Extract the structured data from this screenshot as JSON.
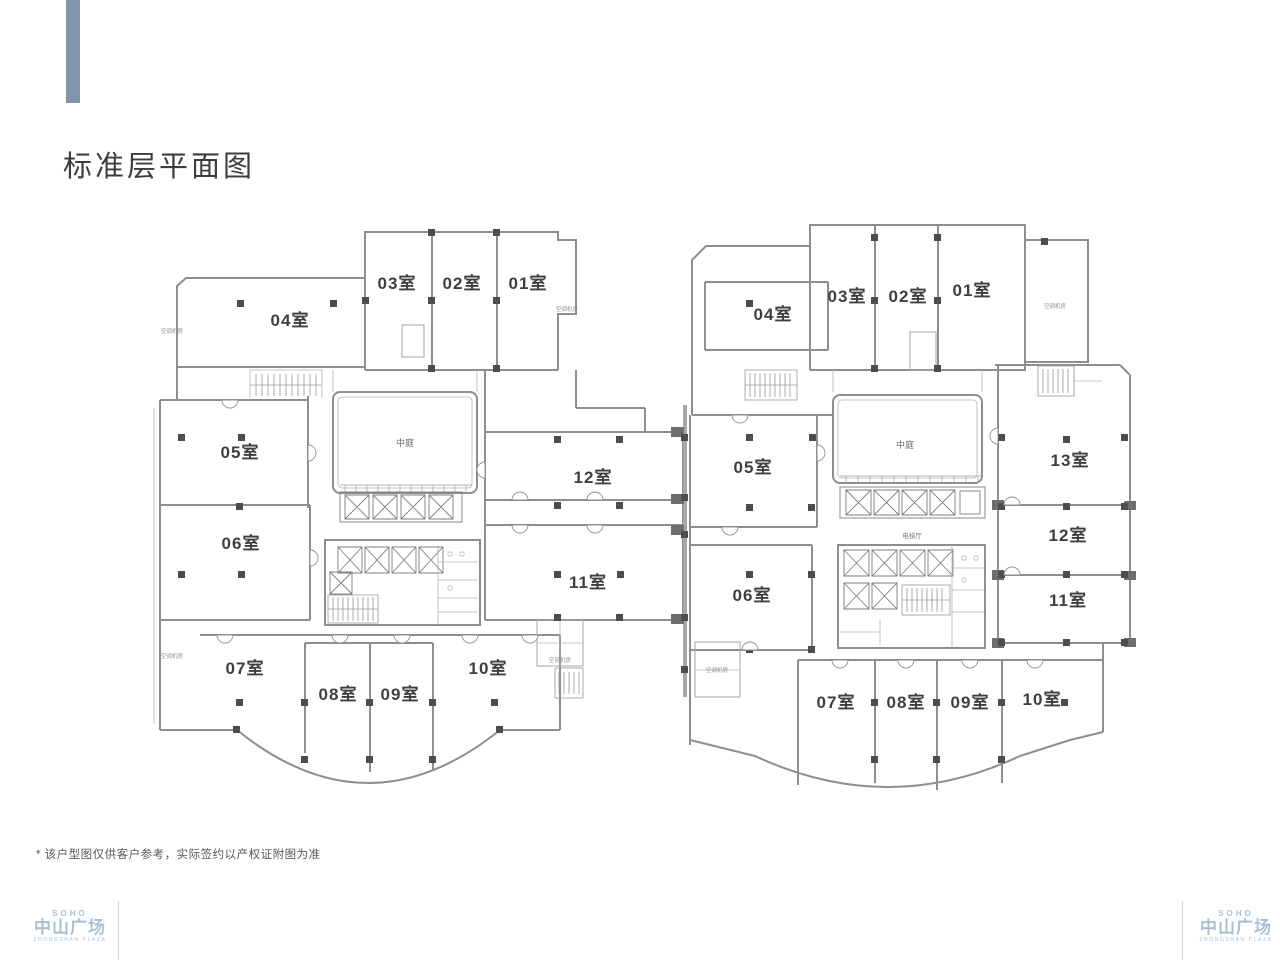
{
  "page": {
    "title": "标准层平面图",
    "footnote": "* 该户型图仅供客户参考，实际签约以产权证附图为准"
  },
  "logo": {
    "brand": "SOHO",
    "name": "中山广场",
    "subtitle": "ZHONGSHAN PLAZA"
  },
  "plans": {
    "atrium_label": "中庭",
    "elevator_hall_label": "电梯厅",
    "service_label": "空调机房",
    "left": {
      "rooms": [
        {
          "label": "01室"
        },
        {
          "label": "02室"
        },
        {
          "label": "03室"
        },
        {
          "label": "04室"
        },
        {
          "label": "05室"
        },
        {
          "label": "06室"
        },
        {
          "label": "07室"
        },
        {
          "label": "08室"
        },
        {
          "label": "09室"
        },
        {
          "label": "10室"
        },
        {
          "label": "11室"
        },
        {
          "label": "12室"
        }
      ]
    },
    "right": {
      "rooms": [
        {
          "label": "01室"
        },
        {
          "label": "02室"
        },
        {
          "label": "03室"
        },
        {
          "label": "04室"
        },
        {
          "label": "05室"
        },
        {
          "label": "06室"
        },
        {
          "label": "07室"
        },
        {
          "label": "08室"
        },
        {
          "label": "09室"
        },
        {
          "label": "10室"
        },
        {
          "label": "11室"
        },
        {
          "label": "12室"
        },
        {
          "label": "13室"
        }
      ]
    }
  }
}
